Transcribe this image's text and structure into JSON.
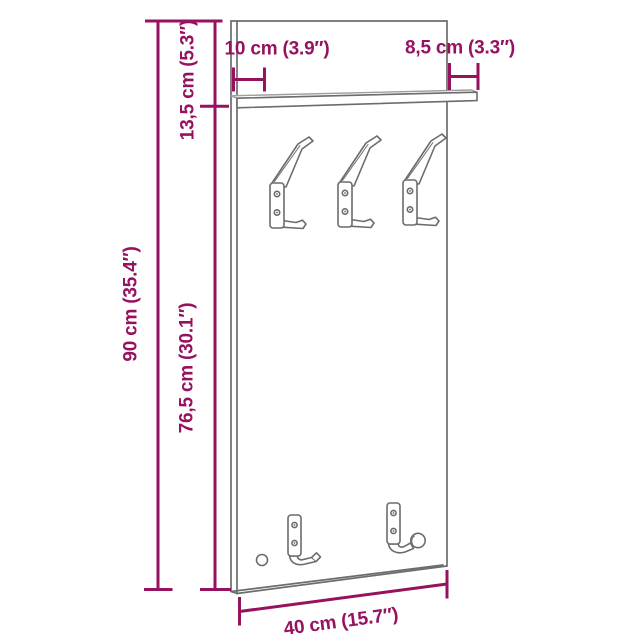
{
  "diagram": {
    "title": "Wall-mounted coat rack — dimension drawing",
    "object": "wall coat rack panel with top shelf, three double coat hooks, two lower hooks and a mounting hole",
    "dimension_labels": {
      "height": "90 cm (35.4″)",
      "lower_section": "76,5 cm (30.1″)",
      "upper_section": "13,5 cm (5.3″)",
      "shelf_left": "10 cm (3.9″)",
      "shelf_right": "8,5 cm (3.3″)",
      "width": "40 cm (15.7″)"
    },
    "parts": {
      "top_hooks_count": 3,
      "bottom_hooks_count": 2,
      "shelf": true,
      "mounting_hole": true
    },
    "colors": {
      "dimension": "#96125e",
      "outline": "#6c6c6c",
      "outline-light": "#9e9e9e",
      "background": "#ffffff"
    }
  }
}
